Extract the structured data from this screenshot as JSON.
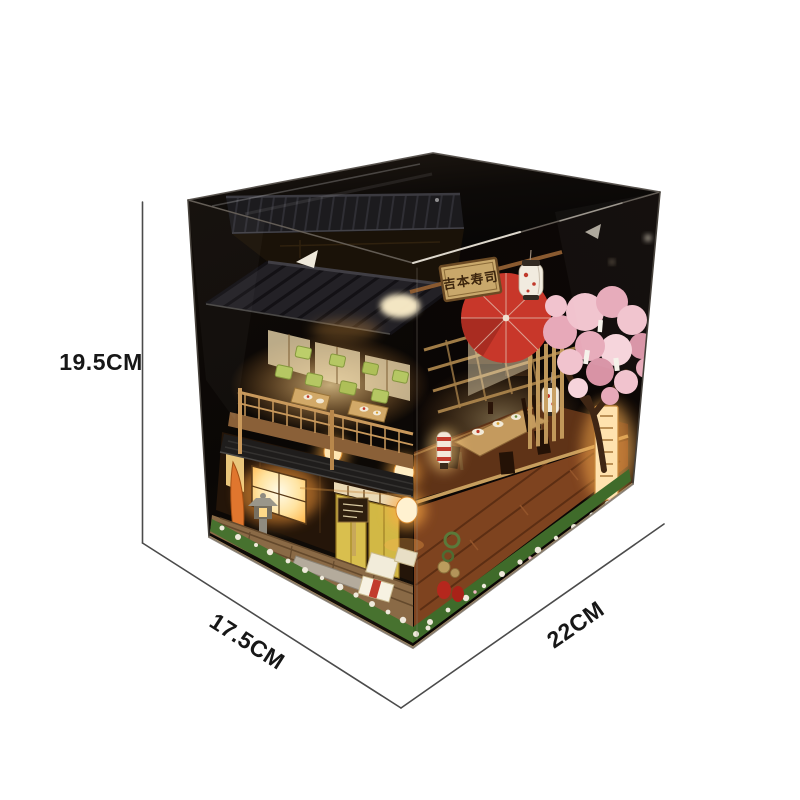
{
  "product": {
    "name": "DIY miniature dollhouse in clear acrylic display box",
    "scene": "Japanese sushi shop diorama with lights, cherry blossom tree and lanterns"
  },
  "dimensions": {
    "height_label": "19.5CM",
    "depth_label": "17.5CM",
    "width_label": "22CM"
  },
  "signboard": {
    "text": "吉本寿司"
  },
  "palette": {
    "background": "#ffffff",
    "dimension_line": "#4b4b4b",
    "label_text": "#171717",
    "box_black": "#0a0807",
    "roof_dark": "#232126",
    "wood_light": "#c9995c",
    "wood_mid": "#8a5a30",
    "cushion_green": "#b5c763",
    "door_yellow": "#d9bf4e",
    "umbrella_red": "#c8372a",
    "blossom_pink": "#f1c3ce",
    "moss_green": "#47722f",
    "warm_glow": "#ffd080"
  }
}
